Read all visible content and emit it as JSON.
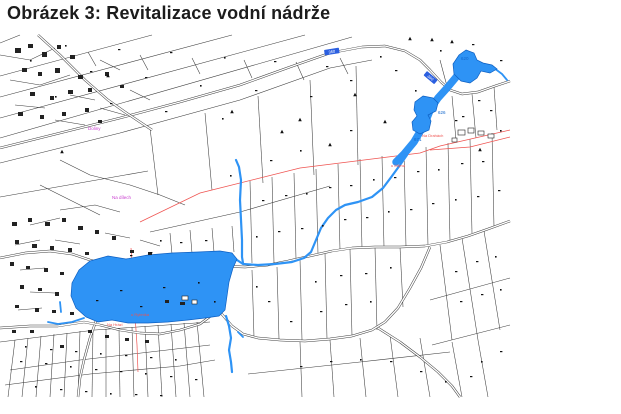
{
  "title": "Obrázek 3: Revitalizace vodní nádrže",
  "map": {
    "colors": {
      "water": "#2e93f5",
      "waterStroke": "#0d5fc2",
      "line": "#3b3b3b",
      "red": "#ef5350",
      "magenta": "#c83ccf",
      "blue": "#1166cc",
      "plate": "#2b5fe0"
    },
    "parcel_lines": [
      "0,76 152,35",
      "0,97 232,35",
      "0,118 305,35",
      "0,138 352,37",
      "0,163 120,133 240,100 330,68 372,60",
      "150,128 158,195",
      "205,113 212,190",
      "258,96 263,183",
      "310,80 314,175",
      "356,66 358,165",
      "88,52 96,66",
      "140,55 148,70",
      "192,58 200,74",
      "244,60 252,78",
      "296,62 304,80",
      "340,58 348,74",
      "20,35 0,43",
      "0,197 148,171",
      "452,96 456,140",
      "472,94 476,138",
      "494,87 497,130",
      "440,60 448,90",
      "250,181 252,263",
      "272,177 274,263",
      "294,173 296,259",
      "316,169 318,254",
      "338,164 340,250",
      "360,159 362,248",
      "382,156 384,247",
      "404,151 406,247",
      "426,147 428,246",
      "448,143 450,241",
      "470,139 472,233",
      "492,133 494,227",
      "150,232 240,212 330,186",
      "170,233 172,254",
      "190,230 192,253",
      "212,228 214,252",
      "232,226 234,252",
      "300,259 302,340",
      "325,253 327,339",
      "350,249 352,336",
      "375,247 377,330",
      "400,247 403,307",
      "440,245 452,340",
      "452,342 462,397",
      "462,238 478,340",
      "478,340 488,397",
      "484,231 500,330",
      "430,300 510,278",
      "432,345 510,325",
      "248,374 360,362 450,352",
      "252,270 254,337",
      "277,267 279,339",
      "300,342 302,397",
      "330,340 334,397",
      "360,338 366,397",
      "390,335 398,397",
      "420,338 430,397",
      "0,342 95,330 210,322",
      "15,340 8,397",
      "28,338 22,397",
      "41,336 36,397",
      "54,334 50,397",
      "67,333 64,397",
      "80,331 78,397",
      "93,330 92,397",
      "106,329 106,397",
      "119,328 120,397",
      "132,327 134,397",
      "145,326 148,397",
      "158,325 162,397",
      "171,324 176,397",
      "184,323 190,397",
      "197,322 204,397",
      "10,370 80,360 150,352 210,345",
      "5,385 90,374 180,366 215,360",
      "60,210 95,205 120,212",
      "30,225 60,218",
      "15,245 40,240",
      "55,240 80,244",
      "20,270 45,268",
      "30,292 55,293",
      "18,310 42,308",
      "105,233 130,238",
      "140,240 160,246",
      "0,55 30,60 55,48",
      "10,80 40,85 70,75",
      "15,105 45,108",
      "70,95 95,100",
      "100,60 120,70",
      "55,120 85,125",
      "100,108 125,115",
      "130,90 150,100",
      "60,160 90,175 130,185 160,195 185,205",
      "40,185 70,200 100,215"
    ],
    "red_lines": [
      "140,222 200,193 300,168 420,153 440,146 510,130",
      "430,150 470,147 510,137",
      "131,248 134,290 135,315 137,345 138,372"
    ],
    "roads": [
      "0,148 60,133 120,118 180,102 240,85 290,67 330,53 362,47 385,46 405,51 420,60 430,70 441,82 450,90 462,94 478,92 495,86 510,81",
      "196,262 220,266 245,267 268,265 288,261 310,256 332,251 352,248 375,247 400,247 425,246 447,242 468,236 488,229 510,221",
      "430,247 421,268 410,288 398,308 385,322 372,330 352,336 330,339 305,341 280,340 258,338 243,334 232,326 220,312 210,301 202,295",
      "378,328 400,342 420,357 438,372 452,386 460,397",
      "0,258 25,253 50,251 72,254 90,260 110,266 135,269 160,268 180,265 196,262",
      "92,261 97,280 99,300 97,318 90,338 84,360 80,378 78,397",
      "0,328 30,326 58,326 84,322 100,325 120,330 140,333 160,334 180,330 200,324 212,315",
      "38,35 60,55 85,80 108,100 125,112 140,122 152,130"
    ],
    "streams": [
      {
        "w": 7.5,
        "p": "457,76 447,88 438,98 431,108 427,118 421,130 414,142 404,154 396,162"
      },
      {
        "w": 2.2,
        "p": "407,155 400,165 392,176 383,188 372,197 358,202 345,205 336,210 328,218 321,228 316,240 311,252 304,258 292,262 275,264 258,265 243,264 234,258"
      },
      {
        "w": 2.2,
        "p": "236,160 239,167 241,180 240,200 241,220 242,240 242,257 243,263"
      },
      {
        "w": 2.2,
        "p": "226,316 229,326 231,338 229,350 231,362 232,372"
      },
      {
        "w": 1.8,
        "p": "238,332 243,337"
      },
      {
        "w": 1.8,
        "p": "84,318 72,322 58,324 48,322"
      },
      {
        "w": 1.8,
        "p": "60,302 61,312"
      },
      {
        "w": 1.8,
        "p": "494,68 502,74 507,80"
      }
    ],
    "water_bodies": [
      {
        "name": "main-pond",
        "points": "90,261 108,256 126,259 148,255 172,253 198,252 220,251 232,253 237,259 233,268 229,282 227,296 225,310 219,316 205,318 188,320 168,322 148,323 128,323 112,320 98,322 86,317 76,308 71,296 72,283 79,270"
      },
      {
        "name": "mid-pond",
        "points": "423,96 433,98 438,103 436,111 428,115 431,121 429,130 420,134 413,130 412,122 417,116 414,110 415,102"
      },
      {
        "name": "top-pond",
        "points": "466,50 474,53 477,60 483,63 492,65 497,69 490,73 481,71 477,78 470,83 461,81 454,74 453,64 459,55"
      }
    ],
    "buildings_filled": [
      [
        15,
        48,
        6,
        5
      ],
      [
        28,
        44,
        5,
        4
      ],
      [
        42,
        52,
        5,
        5
      ],
      [
        57,
        45,
        4,
        4
      ],
      [
        70,
        55,
        5,
        4
      ],
      [
        22,
        68,
        5,
        4
      ],
      [
        38,
        72,
        4,
        4
      ],
      [
        55,
        68,
        5,
        5
      ],
      [
        78,
        75,
        5,
        4
      ],
      [
        30,
        92,
        5,
        4
      ],
      [
        50,
        96,
        4,
        4
      ],
      [
        68,
        90,
        5,
        4
      ],
      [
        88,
        88,
        4,
        4
      ],
      [
        18,
        112,
        5,
        4
      ],
      [
        40,
        115,
        4,
        4
      ],
      [
        62,
        112,
        4,
        4
      ],
      [
        85,
        108,
        4,
        4
      ],
      [
        105,
        72,
        4,
        4
      ],
      [
        120,
        85,
        4,
        3
      ],
      [
        98,
        120,
        4,
        3
      ],
      [
        12,
        222,
        5,
        4
      ],
      [
        28,
        218,
        4,
        4
      ],
      [
        45,
        222,
        5,
        4
      ],
      [
        62,
        218,
        4,
        4
      ],
      [
        78,
        226,
        5,
        4
      ],
      [
        95,
        230,
        4,
        4
      ],
      [
        112,
        236,
        4,
        4
      ],
      [
        15,
        240,
        4,
        4
      ],
      [
        32,
        244,
        5,
        4
      ],
      [
        50,
        246,
        4,
        4
      ],
      [
        68,
        248,
        4,
        4
      ],
      [
        85,
        252,
        4,
        3
      ],
      [
        10,
        262,
        4,
        4
      ],
      [
        26,
        266,
        4,
        3
      ],
      [
        44,
        268,
        4,
        4
      ],
      [
        60,
        272,
        4,
        3
      ],
      [
        20,
        285,
        4,
        4
      ],
      [
        38,
        288,
        4,
        3
      ],
      [
        55,
        292,
        4,
        4
      ],
      [
        15,
        305,
        4,
        3
      ],
      [
        35,
        308,
        4,
        4
      ],
      [
        52,
        310,
        4,
        3
      ],
      [
        70,
        312,
        4,
        3
      ],
      [
        88,
        330,
        4,
        3
      ],
      [
        105,
        335,
        4,
        3
      ],
      [
        125,
        338,
        4,
        3
      ],
      [
        145,
        340,
        4,
        3
      ],
      [
        60,
        345,
        4,
        3
      ],
      [
        30,
        330,
        4,
        3
      ],
      [
        12,
        330,
        4,
        3
      ],
      [
        130,
        250,
        4,
        3
      ],
      [
        148,
        252,
        4,
        3
      ],
      [
        165,
        300,
        4,
        3
      ],
      [
        180,
        302,
        5,
        3
      ]
    ],
    "buildings_outlined": [
      [
        458,
        130,
        7,
        5
      ],
      [
        468,
        128,
        6,
        5
      ],
      [
        478,
        131,
        6,
        4
      ],
      [
        488,
        134,
        6,
        4
      ],
      [
        452,
        138,
        5,
        4
      ],
      [
        182,
        296,
        6,
        4
      ],
      [
        192,
        300,
        5,
        4
      ]
    ],
    "symbols": [
      [
        65,
        45
      ],
      [
        118,
        49
      ],
      [
        170,
        52
      ],
      [
        224,
        57
      ],
      [
        274,
        61
      ],
      [
        326,
        66
      ],
      [
        30,
        60
      ],
      [
        90,
        71
      ],
      [
        145,
        77
      ],
      [
        200,
        85
      ],
      [
        255,
        90
      ],
      [
        310,
        96
      ],
      [
        55,
        96
      ],
      [
        110,
        103
      ],
      [
        165,
        111
      ],
      [
        222,
        118
      ],
      [
        350,
        80
      ],
      [
        395,
        70
      ],
      [
        440,
        50
      ],
      [
        472,
        44
      ],
      [
        500,
        60
      ],
      [
        415,
        90
      ],
      [
        490,
        110
      ],
      [
        462,
        116
      ],
      [
        380,
        56
      ],
      [
        262,
        200
      ],
      [
        285,
        195
      ],
      [
        306,
        193
      ],
      [
        329,
        187
      ],
      [
        350,
        185
      ],
      [
        373,
        179
      ],
      [
        394,
        177
      ],
      [
        417,
        171
      ],
      [
        438,
        169
      ],
      [
        461,
        163
      ],
      [
        482,
        161
      ],
      [
        256,
        236
      ],
      [
        278,
        231
      ],
      [
        301,
        228
      ],
      [
        322,
        225
      ],
      [
        344,
        219
      ],
      [
        366,
        217
      ],
      [
        388,
        211
      ],
      [
        410,
        209
      ],
      [
        432,
        203
      ],
      [
        455,
        199
      ],
      [
        477,
        196
      ],
      [
        498,
        190
      ],
      [
        160,
        240
      ],
      [
        180,
        242
      ],
      [
        205,
        240
      ],
      [
        315,
        281
      ],
      [
        340,
        275
      ],
      [
        365,
        273
      ],
      [
        390,
        267
      ],
      [
        455,
        271
      ],
      [
        476,
        261
      ],
      [
        495,
        256
      ],
      [
        460,
        301
      ],
      [
        481,
        294
      ],
      [
        500,
        289
      ],
      [
        320,
        311
      ],
      [
        345,
        304
      ],
      [
        370,
        301
      ],
      [
        290,
        321
      ],
      [
        268,
        301
      ],
      [
        256,
        286
      ],
      [
        300,
        366
      ],
      [
        330,
        361
      ],
      [
        360,
        359
      ],
      [
        390,
        361
      ],
      [
        420,
        371
      ],
      [
        445,
        381
      ],
      [
        470,
        376
      ],
      [
        500,
        351
      ],
      [
        481,
        361
      ],
      [
        20,
        361
      ],
      [
        45,
        363
      ],
      [
        70,
        366
      ],
      [
        95,
        369
      ],
      [
        120,
        371
      ],
      [
        145,
        373
      ],
      [
        170,
        376
      ],
      [
        195,
        379
      ],
      [
        35,
        386
      ],
      [
        60,
        389
      ],
      [
        85,
        391
      ],
      [
        110,
        393
      ],
      [
        135,
        394
      ],
      [
        160,
        395
      ],
      [
        25,
        346
      ],
      [
        50,
        349
      ],
      [
        75,
        351
      ],
      [
        100,
        353
      ],
      [
        125,
        355
      ],
      [
        150,
        357
      ],
      [
        175,
        359
      ],
      [
        120,
        290
      ],
      [
        163,
        287
      ],
      [
        198,
        282
      ],
      [
        96,
        300
      ],
      [
        140,
        306
      ],
      [
        214,
        301
      ],
      [
        478,
        100
      ],
      [
        455,
        120
      ],
      [
        500,
        130
      ],
      [
        130,
        255
      ],
      [
        150,
        252
      ],
      [
        300,
        150
      ],
      [
        350,
        130
      ],
      [
        270,
        160
      ],
      [
        230,
        175
      ]
    ],
    "triangles": [
      [
        410,
        39
      ],
      [
        432,
        40
      ],
      [
        452,
        42
      ],
      [
        108,
        76
      ],
      [
        232,
        112
      ],
      [
        385,
        122
      ],
      [
        62,
        152
      ],
      [
        282,
        132
      ],
      [
        355,
        95
      ],
      [
        330,
        145
      ],
      [
        480,
        150
      ],
      [
        300,
        120
      ]
    ],
    "labels": [
      {
        "t": "Doliny",
        "x": 88,
        "y": 130,
        "c": "magenta",
        "s": 4.5
      },
      {
        "t": "Na dílech",
        "x": 112,
        "y": 199,
        "c": "magenta",
        "s": 4.5
      },
      {
        "t": "u Mlýna",
        "x": 391,
        "y": 167,
        "c": "red",
        "s": 4
      },
      {
        "t": "Na Drahách",
        "x": 422,
        "y": 137,
        "c": "red",
        "s": 4
      },
      {
        "t": "u Rybníka",
        "x": 131,
        "y": 316,
        "c": "red",
        "s": 4
      },
      {
        "t": "Na Hrázi",
        "x": 107,
        "y": 326,
        "c": "red",
        "s": 4
      },
      {
        "t": "620",
        "x": 461,
        "y": 60,
        "c": "blue",
        "s": 4.5
      },
      {
        "t": "626",
        "x": 438,
        "y": 114,
        "c": "blue",
        "s": 4.5
      },
      {
        "t": "671",
        "x": 414,
        "y": 141,
        "c": "blue",
        "s": 4.5
      }
    ],
    "road_plates": [
      {
        "t": "360",
        "x": 324,
        "y": 50,
        "w": 15,
        "h": 5.5,
        "r": -9
      },
      {
        "t": "360",
        "x": 427,
        "y": 71,
        "w": 14,
        "h": 5.5,
        "r": 40
      }
    ]
  }
}
